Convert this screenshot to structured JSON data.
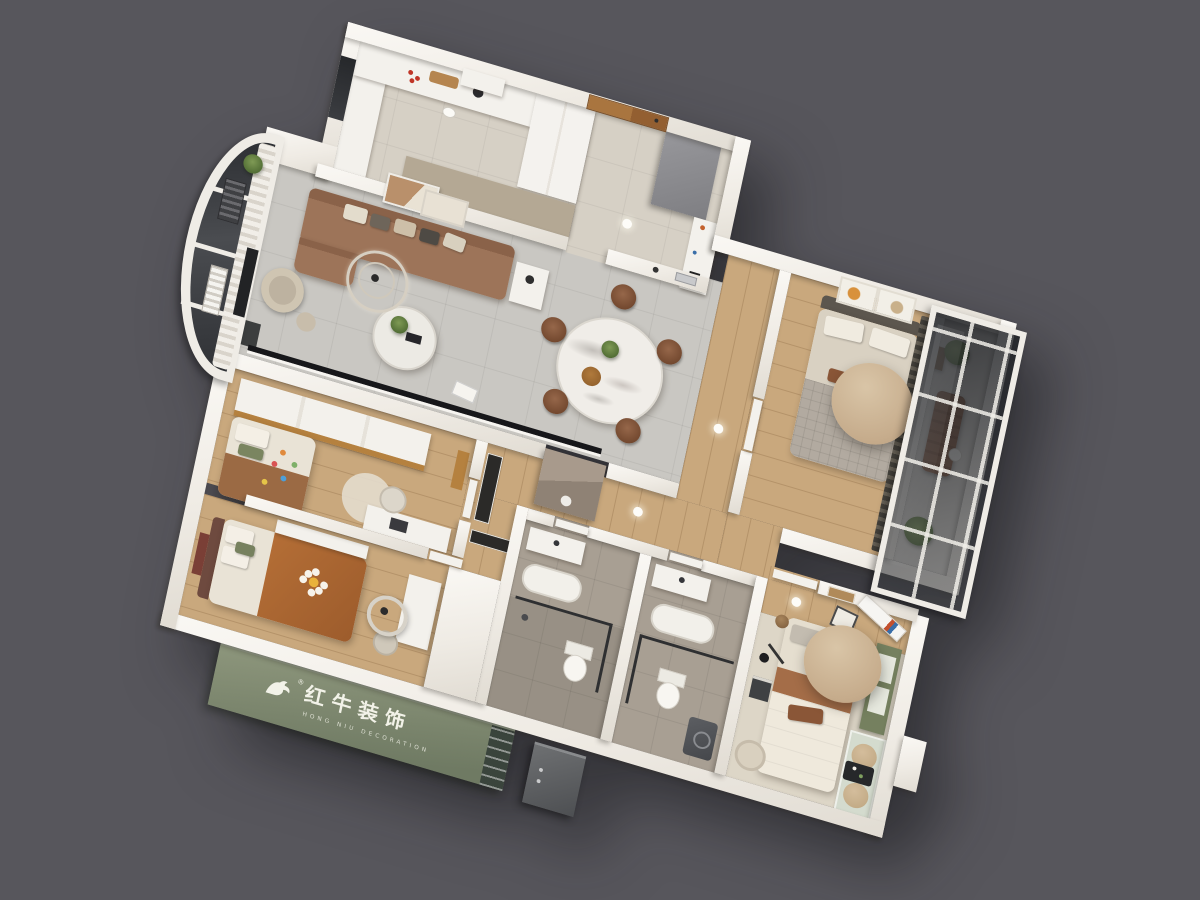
{
  "scene": {
    "type": "3d-axonometric-floorplan-render",
    "background_color": "#57565c",
    "description": "Top-down 3D render of a three-bedroom apartment with white walls"
  },
  "brand": {
    "icon": "bull-logo-icon",
    "registered": "®",
    "name_cn": "红牛装饰",
    "name_en": "HONG NIU DECORATION",
    "panel_color": "#7f8a6e",
    "text_color": "#f2f2e8"
  },
  "palette": {
    "wall_white": "#f2efe9",
    "tile_gray": "#c9c7c2",
    "tile_warm": "#d6d0c5",
    "wood": "#c9a87d",
    "bath_floor": "#a89f93",
    "carpet": "#ddd6c7",
    "sofa_brown": "#9d7459",
    "chair_brown": "#8a5a3c",
    "lamp_tan": "#c9b092",
    "accent_green": "#75805f",
    "glass_dark": "#2f3236",
    "gray_unit": "#8b8b8d"
  },
  "rooms": [
    {
      "name": "kitchen"
    },
    {
      "name": "entry-foyer"
    },
    {
      "name": "living-room"
    },
    {
      "name": "dining-area"
    },
    {
      "name": "curved-balcony"
    },
    {
      "name": "bedroom-second"
    },
    {
      "name": "sun-balcony"
    },
    {
      "name": "kids-bedroom"
    },
    {
      "name": "bedroom-third"
    },
    {
      "name": "bathroom-guest"
    },
    {
      "name": "bathroom-master"
    },
    {
      "name": "master-bedroom"
    },
    {
      "name": "hallway"
    }
  ]
}
